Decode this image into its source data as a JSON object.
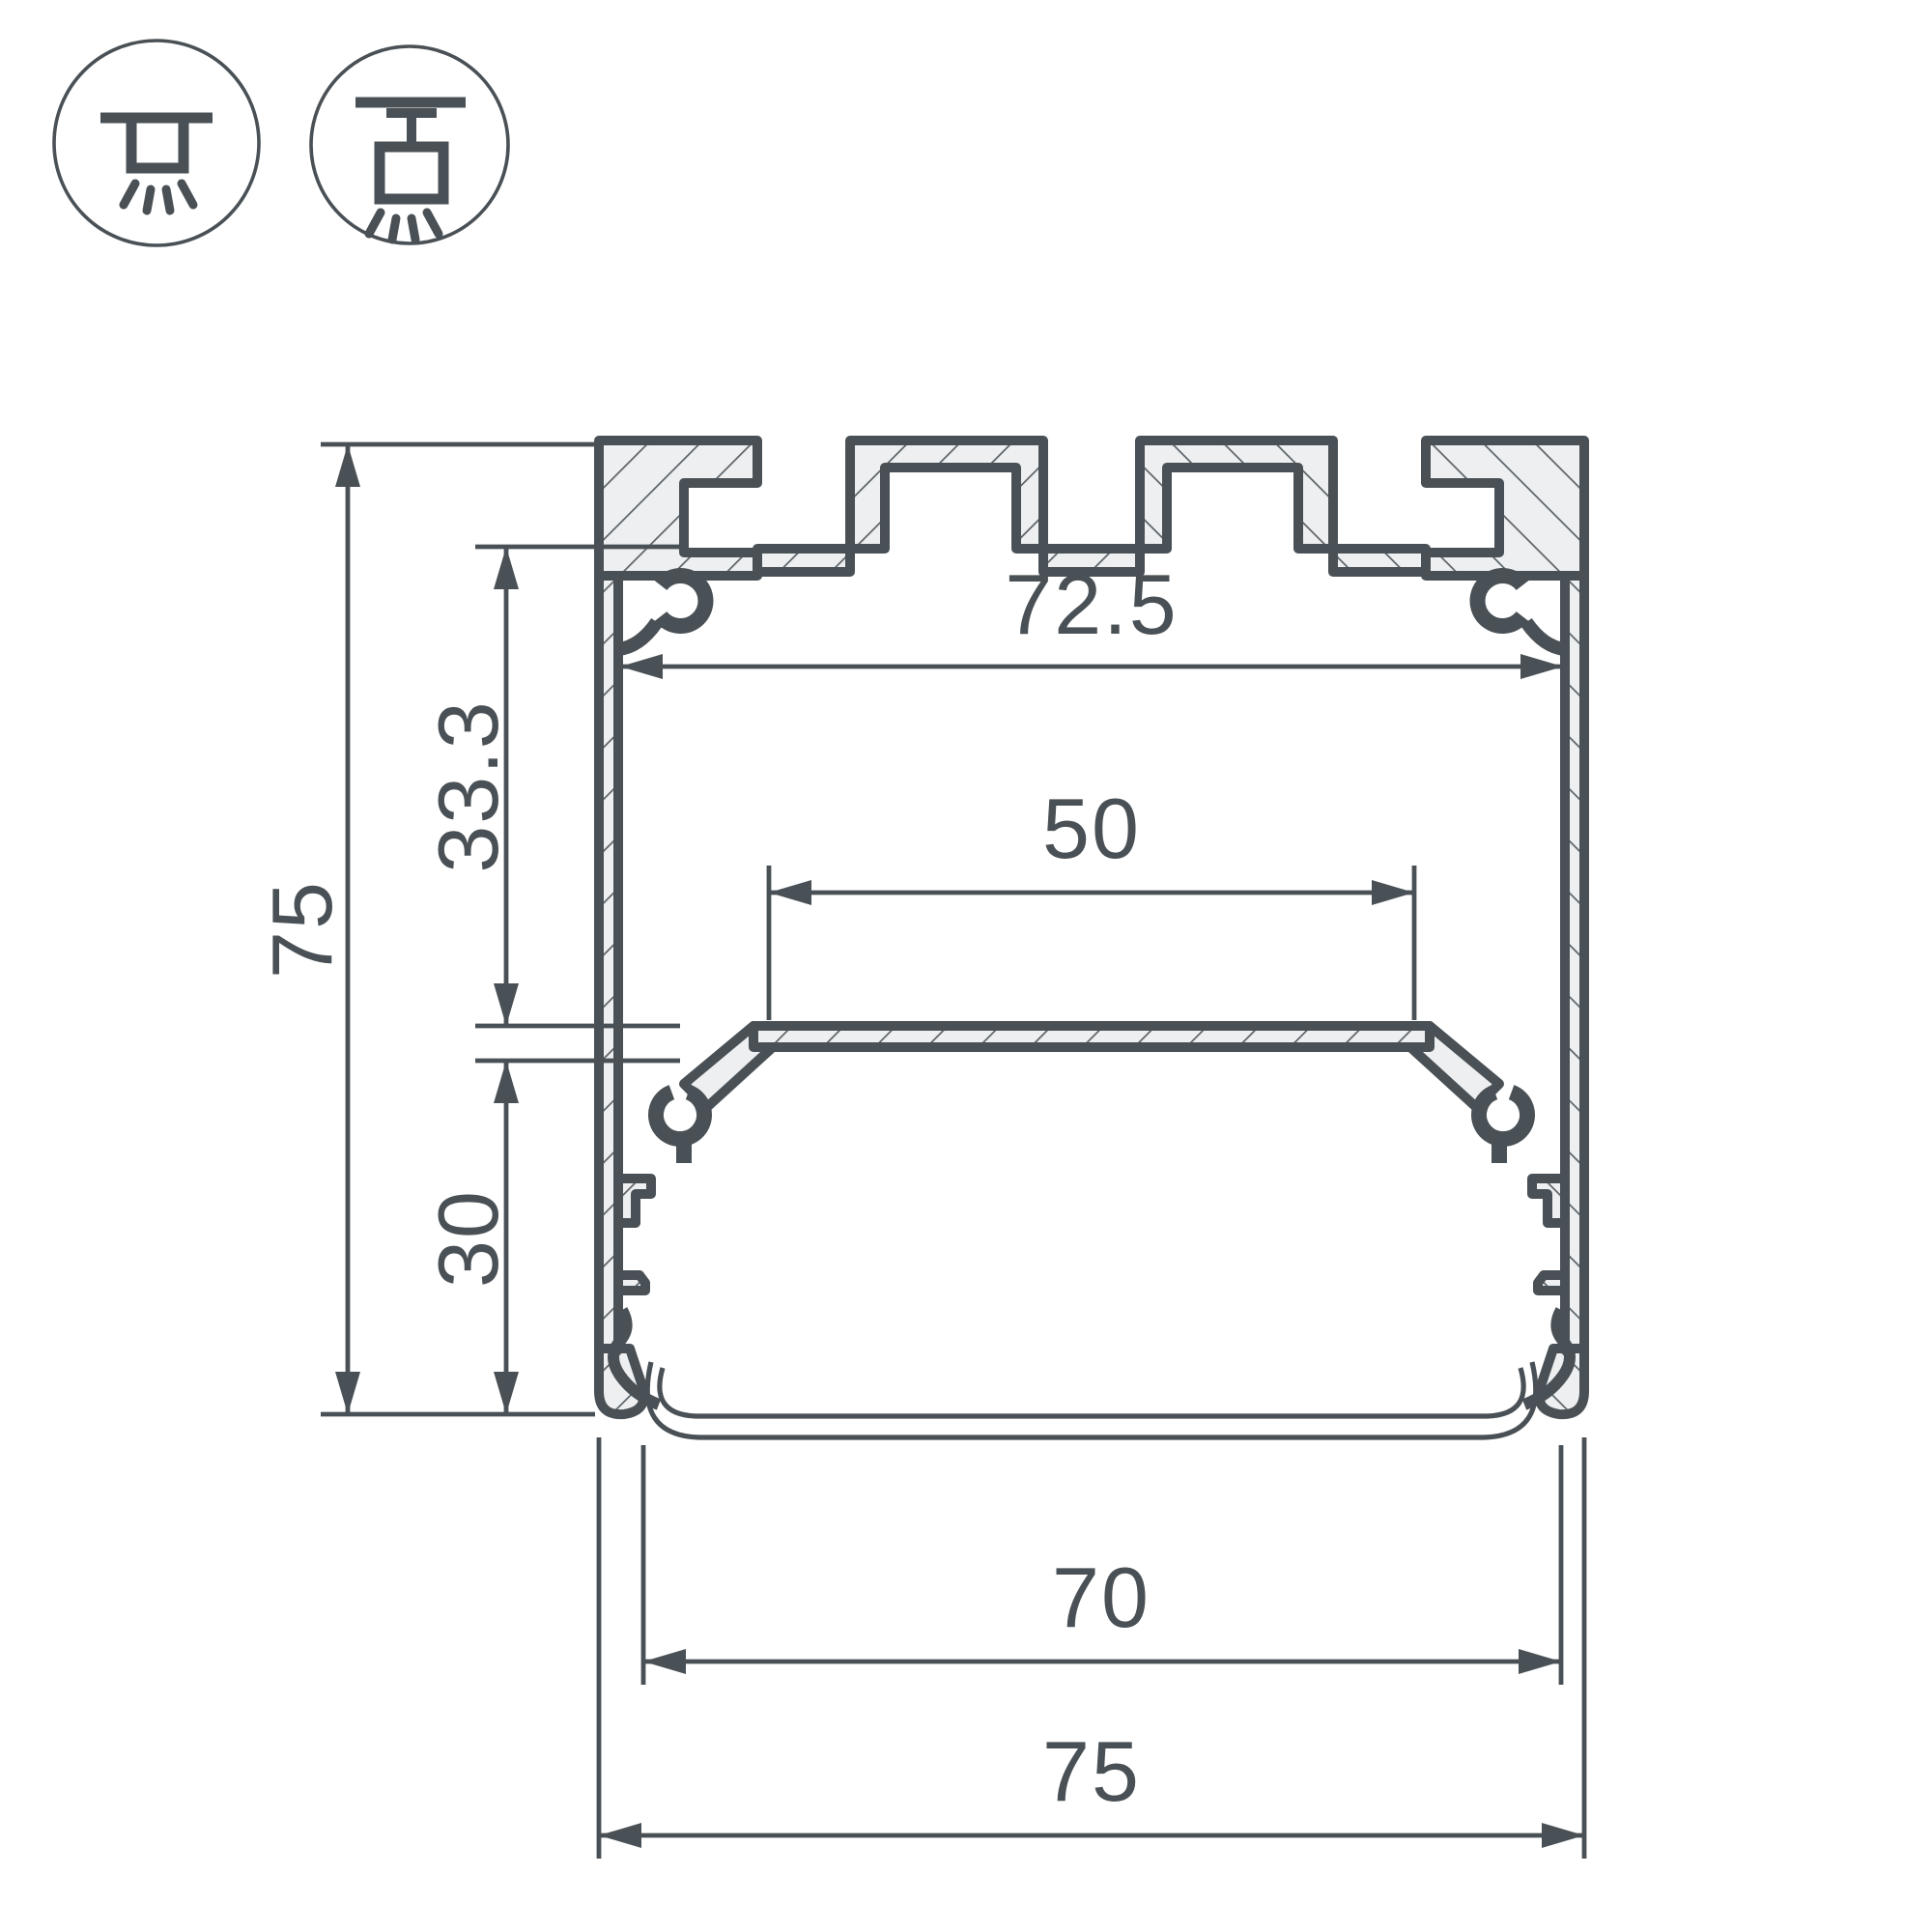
{
  "title": "LED profile cross-section drawing",
  "icons": {
    "surface_mount_label": "surface-mounted-luminaire",
    "suspended_label": "suspended-luminaire"
  },
  "dims": {
    "overall_height": "75",
    "upper_depth": "33.3",
    "lower_depth": "30",
    "inner_width": "72.5",
    "shelf_width": "50",
    "bottom_opening": "70",
    "overall_width": "75"
  },
  "colors": {
    "ink": "#4a5156",
    "aluminum_fill": "#edeff0",
    "background": "#ffffff"
  }
}
